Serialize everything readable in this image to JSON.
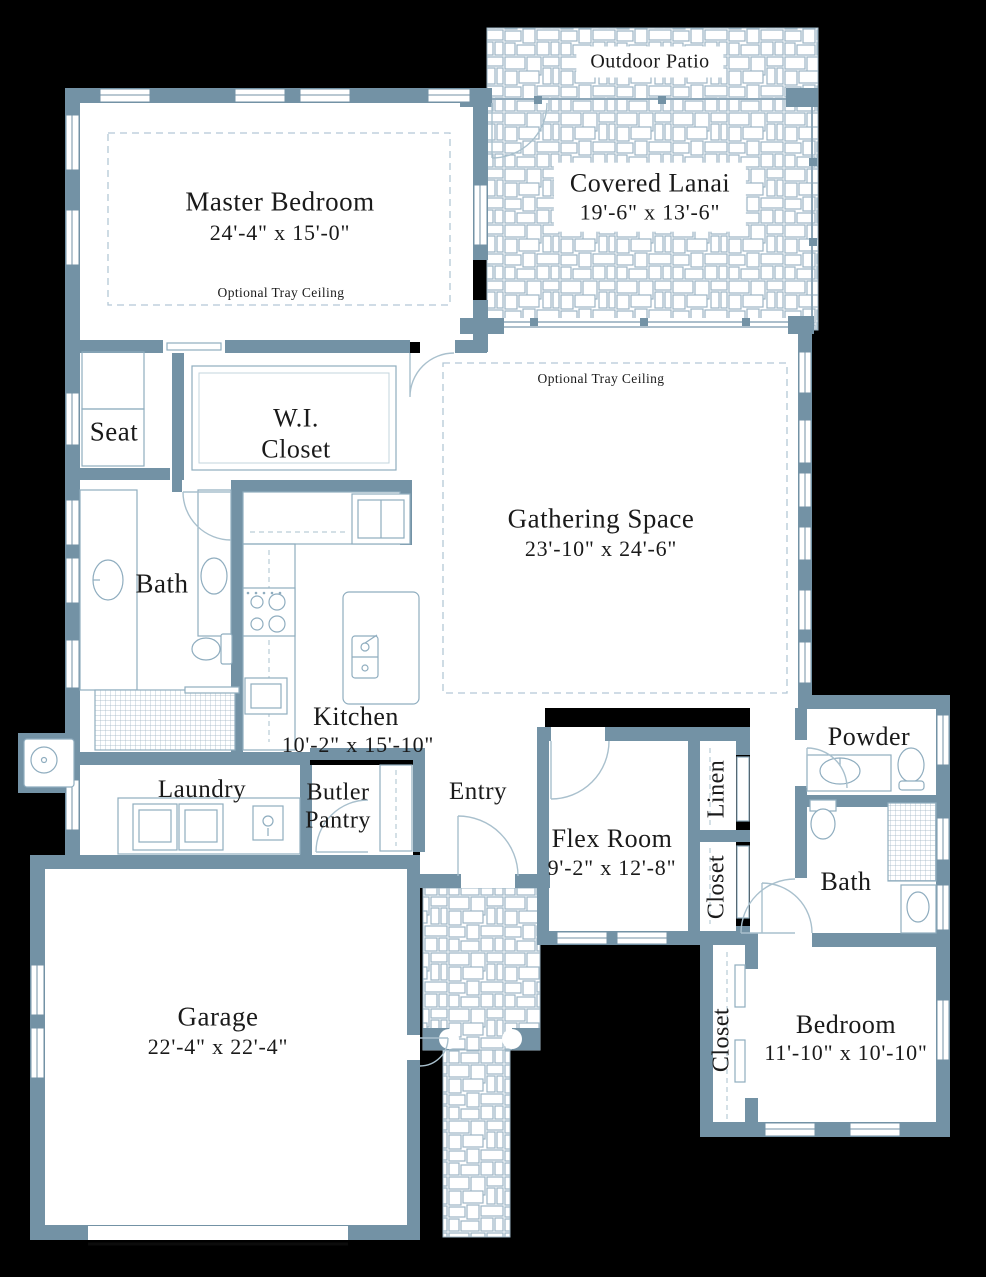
{
  "plan_title": "Single-story home floor plan",
  "colors": {
    "wall": "#7392a5",
    "paver_line": "#9cb5c4",
    "fixture_line": "#8fadbf",
    "tray_dash": "#b3c8d6",
    "text": "#1a1a1a",
    "floor": "#ffffff",
    "background": "#000000"
  },
  "rooms": {
    "outdoor_patio": {
      "name": "Outdoor Patio"
    },
    "covered_lanai": {
      "name": "Covered Lanai",
      "dims": "19'-6\" x 13'-6\""
    },
    "master_bedroom": {
      "name": "Master Bedroom",
      "dims": "24'-4\" x 15'-0\"",
      "note": "Optional Tray Ceiling"
    },
    "gathering_space": {
      "name": "Gathering Space",
      "dims": "23'-10\" x 24'-6\"",
      "note": "Optional Tray Ceiling"
    },
    "wi_closet": {
      "line1": "W.I.",
      "line2": "Closet"
    },
    "seat": {
      "name": "Seat"
    },
    "master_bath": {
      "name": "Bath"
    },
    "kitchen": {
      "name": "Kitchen",
      "dims": "10'-2\" x 15'-10\""
    },
    "laundry": {
      "name": "Laundry"
    },
    "butler_pantry": {
      "line1": "Butler",
      "line2": "Pantry"
    },
    "entry": {
      "name": "Entry"
    },
    "flex_room": {
      "name": "Flex Room",
      "dims": "9'-2\" x 12'-8\""
    },
    "linen": {
      "name": "Linen"
    },
    "flex_closet": {
      "name": "Closet"
    },
    "powder": {
      "name": "Powder"
    },
    "bath2": {
      "name": "Bath"
    },
    "bedroom_closet": {
      "name": "Closet"
    },
    "bedroom": {
      "name": "Bedroom",
      "dims": "11'-10\" x 10'-10\""
    },
    "garage": {
      "name": "Garage",
      "dims": "22'-4\" x 22'-4\""
    }
  }
}
